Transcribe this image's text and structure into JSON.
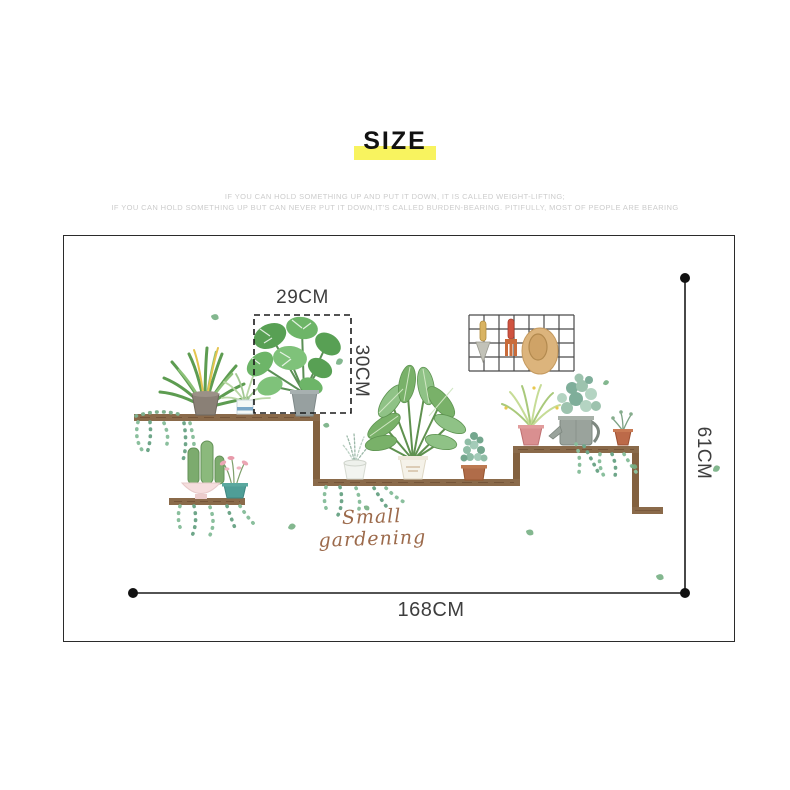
{
  "page": {
    "title": "SIZE",
    "captions": [
      "IF YOU CAN HOLD SOMETHING UP AND PUT IT DOWN, IT IS CALLED WEIGHT-LIFTING;",
      "IF YOU CAN HOLD SOMETHING UP BUT CAN NEVER PUT IT DOWN,IT'S CALLED BURDEN-BEARING. PITIFULLY, MOST OF PEOPLE ARE BEARING"
    ]
  },
  "diagram": {
    "product_script_label": "Small gardening",
    "measurements": {
      "inset_width": "29CM",
      "inset_height": "30CM",
      "overall_height": "61CM",
      "overall_width": "168CM"
    },
    "colors": {
      "title_highlight": "#F8F35F",
      "panel_border": "#2B2B2B",
      "measure_line": "#1A1A1A",
      "shelf_wood": "#8A6A4A",
      "leaf_green": "#6FB26A",
      "ivy_green": "#8ABF9D",
      "pot_pink": "#D98F90",
      "pot_terracotta": "#B06C49",
      "pot_teal": "#4F9E97",
      "script_brown": "#9C6A4B",
      "straw_hat": "#DCB47C"
    },
    "illustrations": [
      "yucca-plant",
      "chlorophytum-plant",
      "monstera-plant",
      "cacti-bowl",
      "pink-flower-pot",
      "herb-pot",
      "leafy-plant",
      "jade-plant",
      "spider-plant-pink-pot",
      "watering-can",
      "sprig-pot",
      "wire-grid-rack",
      "garden-trowel",
      "garden-fork",
      "straw-hat",
      "ivy-vines",
      "stepped-shelf",
      "scattered-leaves"
    ]
  }
}
